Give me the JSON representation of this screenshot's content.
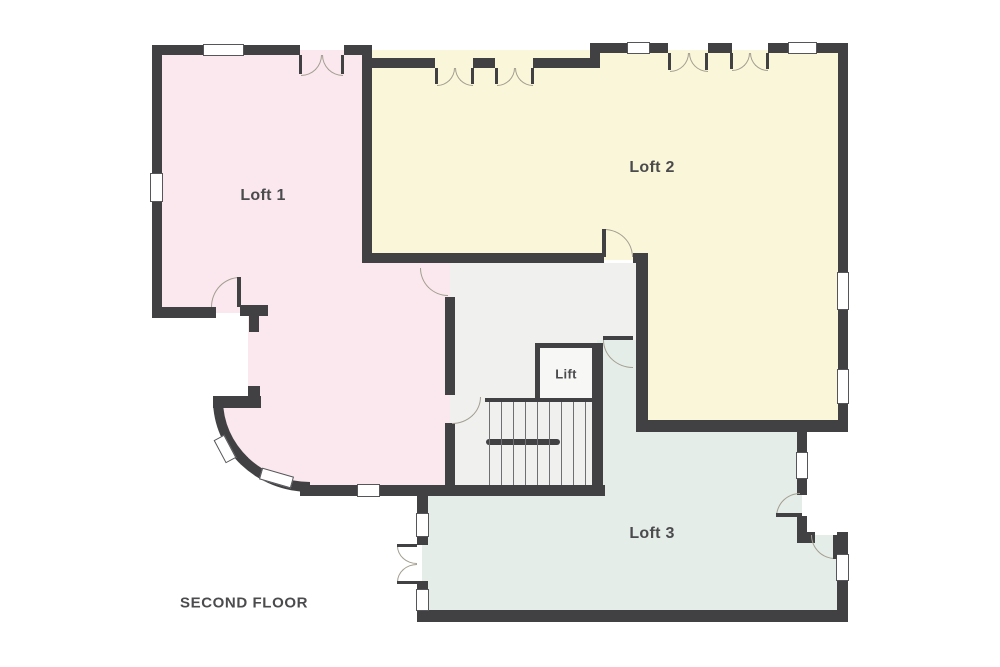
{
  "floor_title": "SECOND FLOOR",
  "rooms": {
    "loft1": {
      "label": "Loft 1",
      "color": "#fae8ee"
    },
    "loft2": {
      "label": "Loft 2",
      "color": "#faf6d9"
    },
    "loft3": {
      "label": "Loft 3",
      "color": "#e4ede7"
    },
    "hall": {
      "color": "#f0f0ef"
    },
    "lift": {
      "label": "Lift",
      "color": "#f7f7f6"
    }
  },
  "colors": {
    "wall": "#414144",
    "background": "#ffffff",
    "door_arc": "#a39e90",
    "window_fill": "#ffffff",
    "window_border": "#55555a",
    "stair_tread": "#6f6f73",
    "label_text": "#4b4b4e"
  }
}
